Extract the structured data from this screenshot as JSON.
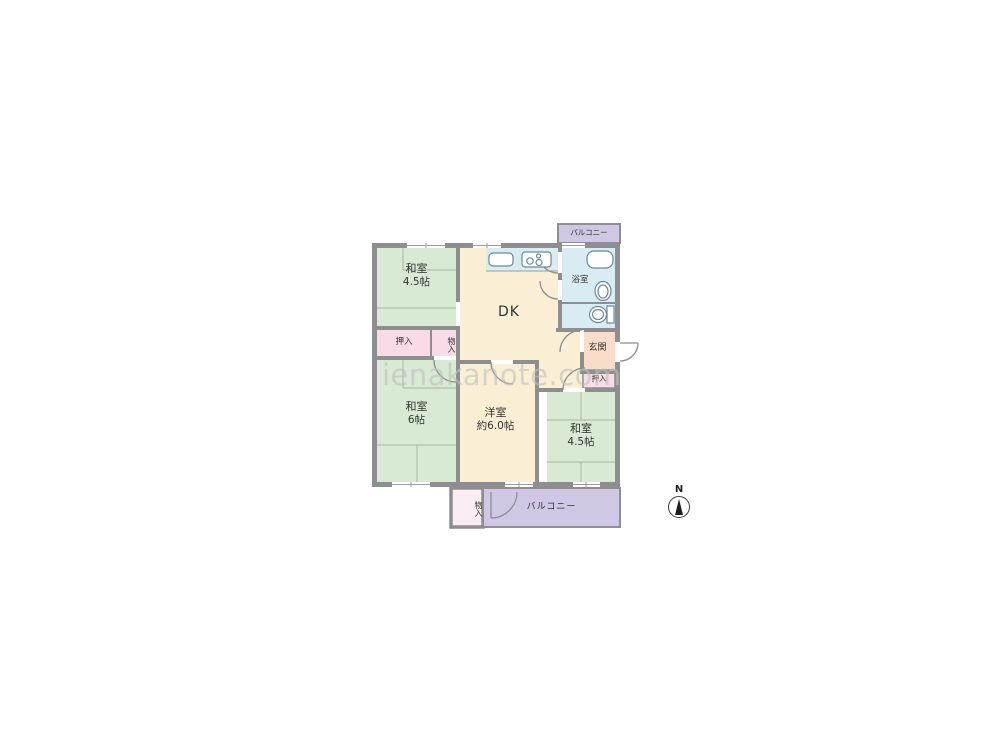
{
  "plan": {
    "balcony_top": {
      "label": "バルコニー"
    },
    "rooms": {
      "washitsu_tl": {
        "name": "和室",
        "size": "4.5帖"
      },
      "dk": {
        "name": "DK"
      },
      "bathroom": {
        "name": "浴室"
      },
      "genkan": {
        "name": "玄関"
      },
      "oshiire_tl": {
        "name": "押入"
      },
      "monoire_tl": {
        "name": "物入"
      },
      "oshiire_r": {
        "name": "押入"
      },
      "washitsu_l": {
        "name": "和室",
        "size": "6帖"
      },
      "yoshitsu": {
        "name": "洋室",
        "size": "約6.0帖"
      },
      "washitsu_r": {
        "name": "和室",
        "size": "4.5帖"
      },
      "monoire_b": {
        "name": "物入"
      },
      "balcony_b": {
        "label": "バルコニー"
      }
    },
    "compass": {
      "label": "N"
    },
    "watermark": {
      "text": "ienakanote.com"
    },
    "colors": {
      "wall": "#8e8e90",
      "line": "#9b9b9d",
      "tatami": "#d8ead3",
      "cream": "#faefd4",
      "pink": "#f8dbe6",
      "pinklight": "#fcecf3",
      "salmon": "#f9ddca",
      "blue": "#d9ecf3",
      "purple": "#cfc7e3",
      "text": "#333333",
      "watermark": "#bfbfbf"
    }
  }
}
